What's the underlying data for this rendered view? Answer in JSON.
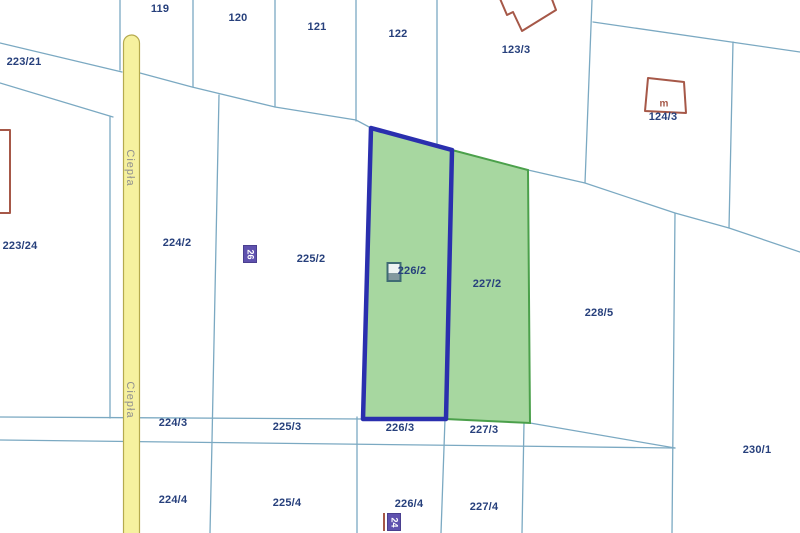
{
  "map": {
    "type": "cadastral-parcel-map",
    "road": {
      "name": "Ciepła",
      "labels": [
        {
          "x": 130,
          "y": 168
        },
        {
          "x": 130,
          "y": 400
        }
      ]
    },
    "parcel_labels": [
      {
        "text": "119",
        "x": 160,
        "y": 9
      },
      {
        "text": "120",
        "x": 238,
        "y": 18
      },
      {
        "text": "121",
        "x": 317,
        "y": 27
      },
      {
        "text": "122",
        "x": 398,
        "y": 34
      },
      {
        "text": "123/3",
        "x": 516,
        "y": 50
      },
      {
        "text": "124/3",
        "x": 663,
        "y": 117
      },
      {
        "text": "223/21",
        "x": 24,
        "y": 62
      },
      {
        "text": "223/24",
        "x": 20,
        "y": 246
      },
      {
        "text": "224/2",
        "x": 177,
        "y": 243
      },
      {
        "text": "225/2",
        "x": 311,
        "y": 259
      },
      {
        "text": "226/2",
        "x": 412,
        "y": 271
      },
      {
        "text": "227/2",
        "x": 487,
        "y": 284
      },
      {
        "text": "228/5",
        "x": 599,
        "y": 313
      },
      {
        "text": "224/3",
        "x": 173,
        "y": 423
      },
      {
        "text": "225/3",
        "x": 287,
        "y": 427
      },
      {
        "text": "226/3",
        "x": 400,
        "y": 428
      },
      {
        "text": "227/3",
        "x": 484,
        "y": 430
      },
      {
        "text": "230/1",
        "x": 757,
        "y": 450
      },
      {
        "text": "224/4",
        "x": 173,
        "y": 500
      },
      {
        "text": "225/4",
        "x": 287,
        "y": 503
      },
      {
        "text": "226/4",
        "x": 409,
        "y": 504
      },
      {
        "text": "227/4",
        "x": 484,
        "y": 507
      }
    ],
    "building_labels": [
      {
        "text": "m",
        "x": 664,
        "y": 104
      }
    ],
    "badges": [
      {
        "text": "26",
        "x": 250,
        "y": 254
      },
      {
        "text": "24",
        "x": 394,
        "y": 522
      }
    ],
    "highlighted_parcels": [
      {
        "id": "226/2",
        "style": "selected-blue-outline"
      },
      {
        "id": "227/2",
        "style": "highlighted-green"
      }
    ],
    "colors": {
      "line": "#7ba9c2",
      "label": "#27407c",
      "road_fill": "#f6f19f",
      "road_border": "#b5aa4e",
      "road_text": "#8f8f8f",
      "green_fill": "#a7d7a0",
      "green_border": "#4ba04b",
      "selection_border": "#2a2fae",
      "building": "#a65848",
      "badge_bg": "#5f51ae"
    }
  }
}
